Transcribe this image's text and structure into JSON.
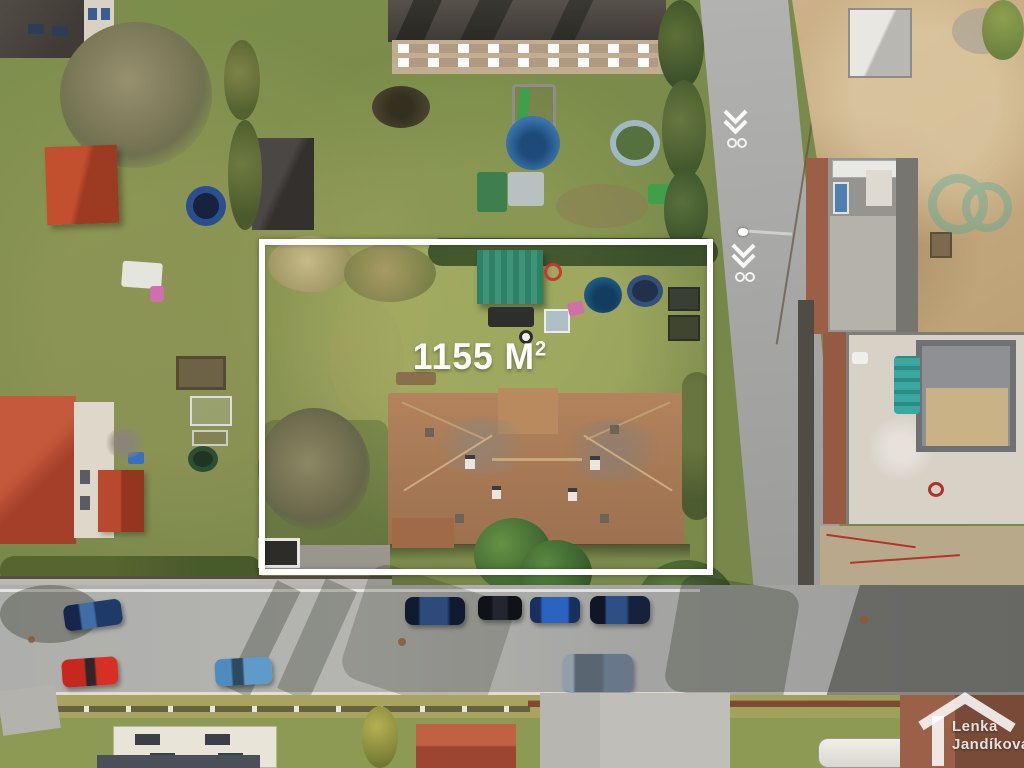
{
  "photo": {
    "area_label": {
      "text": "1155 M",
      "superscript": "2"
    },
    "watermark": {
      "line1": "Lenka",
      "line2": "Jandíková"
    },
    "colors": {
      "boundary_outline": "#ffffff",
      "area_label_text": "#ffffff",
      "watermark_text": "#ffffff",
      "teal_mark": "#3aa89e",
      "road_asphalt": "#a6a6a4",
      "grass": "#7d8c4c",
      "sand": "#c9ae84",
      "main_roof": "#a87a56"
    }
  }
}
